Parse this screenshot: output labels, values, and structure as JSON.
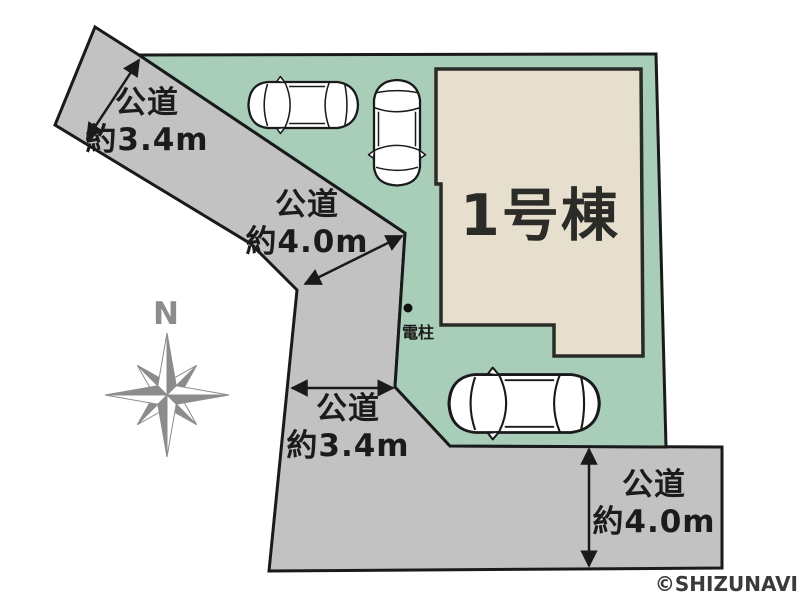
{
  "canvas": {
    "width": 800,
    "height": 599
  },
  "colors": {
    "lot_green": "#a8cdb8",
    "road_gray": "#c3c2c2",
    "building_beige": "#e6dfcd",
    "outline_black": "#1a1a1a",
    "compass_gray": "#8c8c8c"
  },
  "building": {
    "label": "1号棟"
  },
  "roads": [
    {
      "position": "northwest",
      "label_line1": "公道",
      "label_line2": "約3.4m"
    },
    {
      "position": "west-diagonal",
      "label_line1": "公道",
      "label_line2": "約4.0m"
    },
    {
      "position": "southwest",
      "label_line1": "公道",
      "label_line2": "約3.4m"
    },
    {
      "position": "south",
      "label_line1": "公道",
      "label_line2": "約4.0m"
    }
  ],
  "utility_pole": {
    "label": "電柱"
  },
  "compass": {
    "north_label": "N"
  },
  "cars": [
    {
      "orientation": "horizontal-facing-left"
    },
    {
      "orientation": "vertical-facing-down"
    },
    {
      "orientation": "horizontal-facing-left"
    }
  ],
  "copyright": "©SHIZUNAVI"
}
